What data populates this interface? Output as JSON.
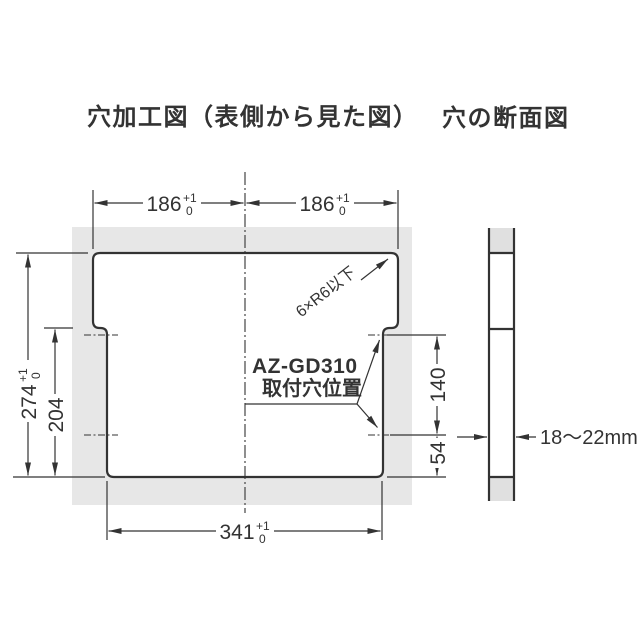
{
  "titles": {
    "hole_machining": "穴加工図（表側から見た図）",
    "hole_section": "穴の断面図"
  },
  "hole_drawing": {
    "dim_top_left": {
      "value": "186",
      "tol_upper": "+1",
      "tol_lower": "0"
    },
    "dim_top_right": {
      "value": "186",
      "tol_upper": "+1",
      "tol_lower": "0"
    },
    "dim_overall_height": {
      "value": "274",
      "tol_upper": "+1",
      "tol_lower": "0"
    },
    "dim_lower_height": {
      "value": "204"
    },
    "dim_hole_pitch": {
      "value": "140"
    },
    "dim_bottom_offset": {
      "value": "54"
    },
    "dim_bottom_width": {
      "value": "341",
      "tol_upper": "+1",
      "tol_lower": "0"
    },
    "corner_note": "6×R6以下",
    "mount_label_line1": "AZ-GD310",
    "mount_label_line2": "取付穴位置"
  },
  "section_drawing": {
    "thickness": "18〜22mm"
  },
  "colors": {
    "line": "#333333",
    "panel": "#e7e7e7",
    "section_fill": "#e0e0e0"
  }
}
